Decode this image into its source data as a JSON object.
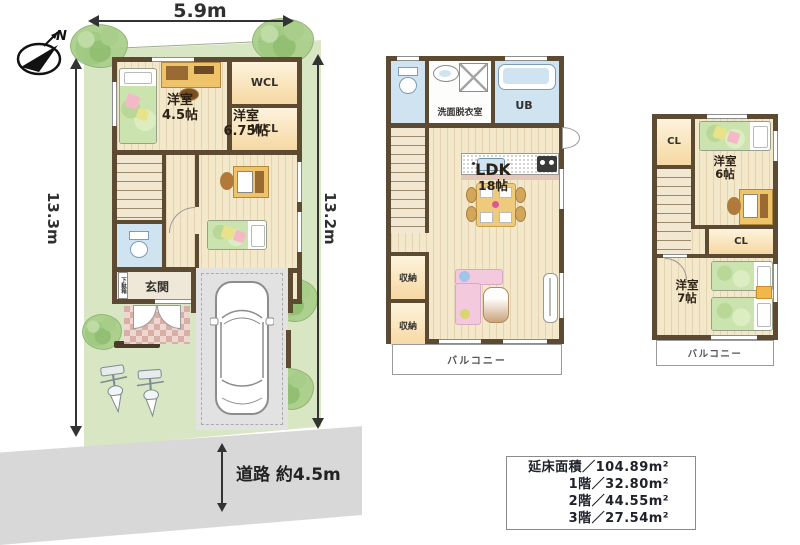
{
  "compass": {
    "label": "N"
  },
  "dimensions": {
    "top": "5.9m",
    "left": "13.3m",
    "right": "13.2m",
    "road": "道路 約4.5m"
  },
  "floor1": {
    "bedroom45": {
      "name": "洋室",
      "size": "4.5帖"
    },
    "wcl_top": "WCL",
    "wcl_bottom": "WCL",
    "bedroom675": {
      "name": "洋室",
      "size": "6.75帖"
    },
    "genkan": "玄関",
    "shoe_cabinet": "下駄箱"
  },
  "floor2": {
    "washroom": "洗面脱衣室",
    "bath": "UB",
    "ldk": {
      "name": "LDK",
      "size": "18帖"
    },
    "storage1": "収納",
    "storage2": "収納",
    "balcony": "バルコニー"
  },
  "floor3": {
    "closet1": "CL",
    "bedroom6": {
      "name": "洋室",
      "size": "6帖"
    },
    "closet2": "CL",
    "bedroom7": {
      "name": "洋室",
      "size": "7帖"
    },
    "balcony": "バルコニー"
  },
  "area_table": {
    "rows": [
      {
        "text": "延床面積／104.89m²"
      },
      {
        "text": "1階／32.80m²"
      },
      {
        "text": "2階／44.55m²"
      },
      {
        "text": "3階／27.54m²"
      }
    ]
  },
  "colors": {
    "wall": "#5d4a33",
    "floor_wood": "#f4e8cb",
    "site_green": "#d9e6c3",
    "water_blue": "#cfe4f0",
    "closet_cream": "#f6d8a2",
    "road_gray": "#d8d8d8"
  }
}
